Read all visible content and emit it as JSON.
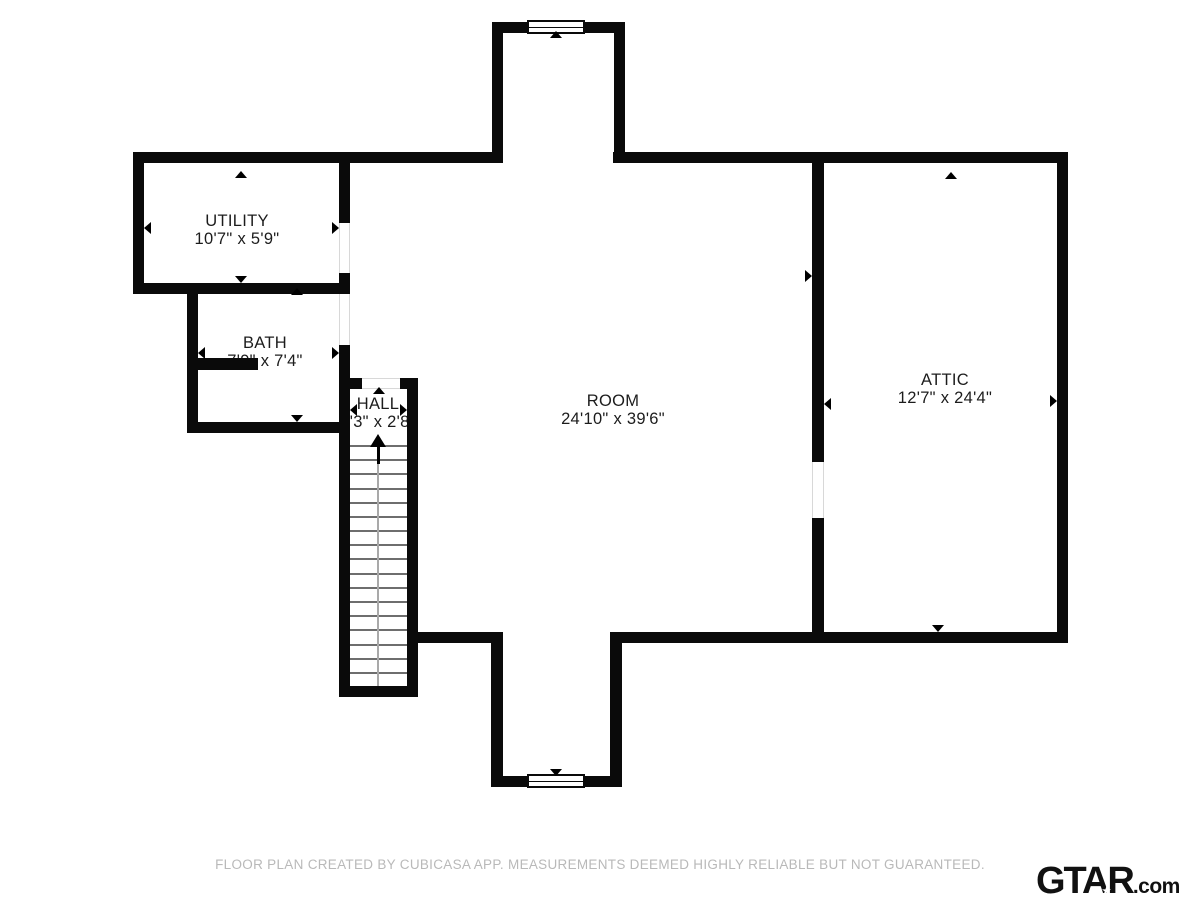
{
  "floorplan": {
    "rooms": {
      "utility": {
        "name": "UTILITY",
        "dims": "10'7\" x 5'9\""
      },
      "bath": {
        "name": "BATH",
        "dims": "7'9\" x 7'4\""
      },
      "hall": {
        "name": "HALL",
        "dims": "3'3\" x 2'8\""
      },
      "room": {
        "name": "ROOM",
        "dims": "24'10\" x 39'6\""
      },
      "attic": {
        "name": "ATTIC",
        "dims": "12'7\" x 24'4\""
      }
    },
    "stairs": {
      "tread_count": 17,
      "direction": "up"
    },
    "windows": {
      "count": 2
    },
    "colors": {
      "wall": "#0a0a0a",
      "background": "#ffffff",
      "label": "#1c1c1c",
      "footer_text": "#b9b9b9",
      "tread": "#6e6e6e"
    }
  },
  "footer": {
    "disclaimer": "FLOOR PLAN CREATED BY CUBICASA APP. MEASUREMENTS DEEMED HIGHLY RELIABLE BUT NOT GUARANTEED."
  },
  "branding": {
    "logo_text": "GTAR",
    "logo_suffix": ".com",
    "logo_star": "★"
  }
}
